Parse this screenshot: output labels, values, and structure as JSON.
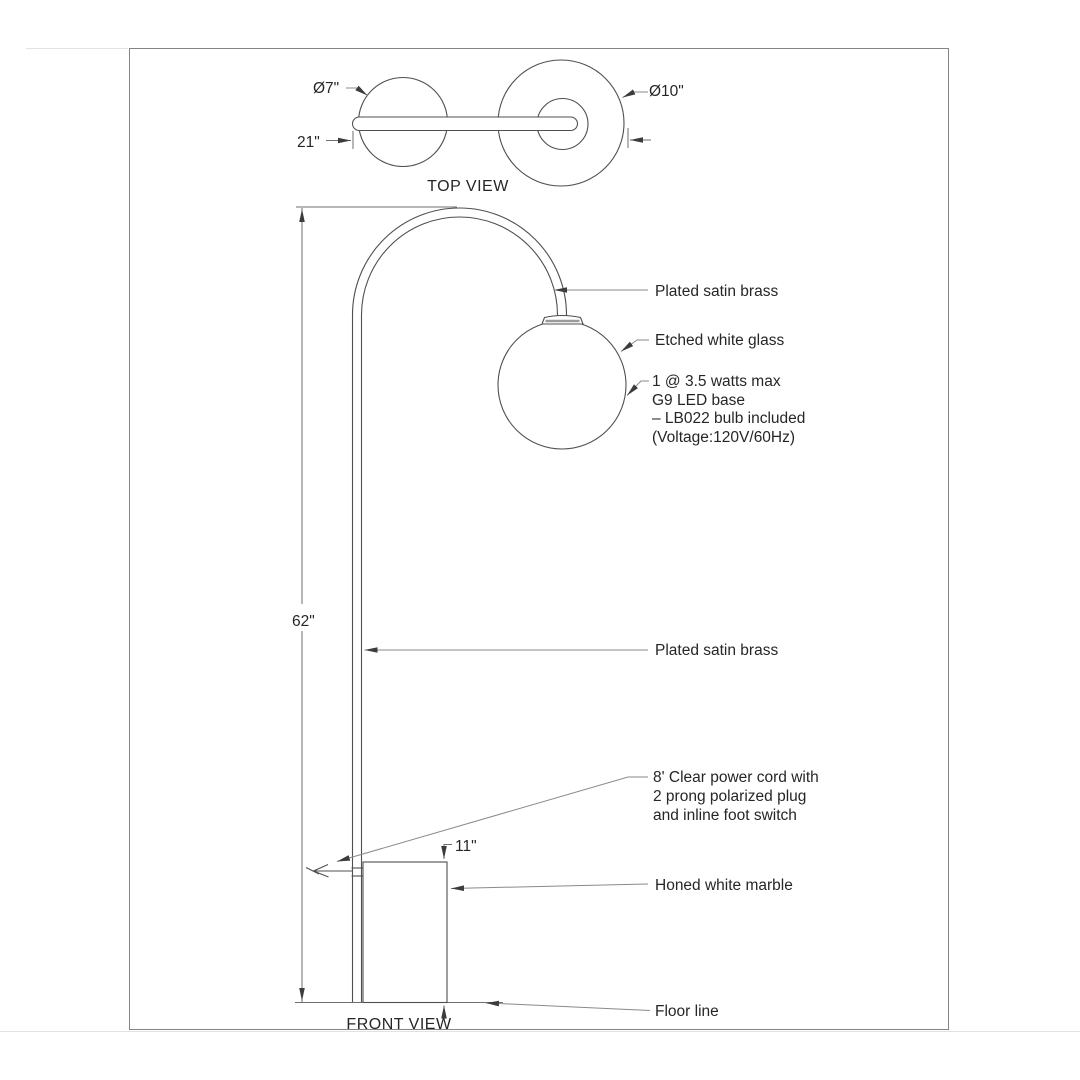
{
  "page": {
    "background": "#ffffff",
    "border_color": "#848484"
  },
  "colors": {
    "object_line": "#4f4f4f",
    "dimension_line": "#6e6e6e",
    "leader_line": "#8a8a8a",
    "text": "#262626"
  },
  "top_view": {
    "title": "TOP VIEW",
    "dim_globe_diameter": "Ø7\"",
    "dim_base_diameter": "Ø10\"",
    "dim_arm_span": "21\""
  },
  "front_view": {
    "title": "FRONT VIEW",
    "dim_overall_height": "62\"",
    "dim_base_height": "11\"",
    "annotations": {
      "arm_material": "Plated satin brass",
      "shade_material": "Etched white glass",
      "bulb_line1": "1 @ 3.5 watts max",
      "bulb_line2": "G9 LED base",
      "bulb_line3": "– LB022 bulb included",
      "bulb_line4": "(Voltage:120V/60Hz)",
      "pole_material": "Plated satin brass",
      "cord_line1": "8' Clear power cord with",
      "cord_line2": "2 prong polarized plug",
      "cord_line3": "and inline foot switch",
      "base_material": "Honed white marble",
      "floor_label": "Floor line"
    }
  }
}
